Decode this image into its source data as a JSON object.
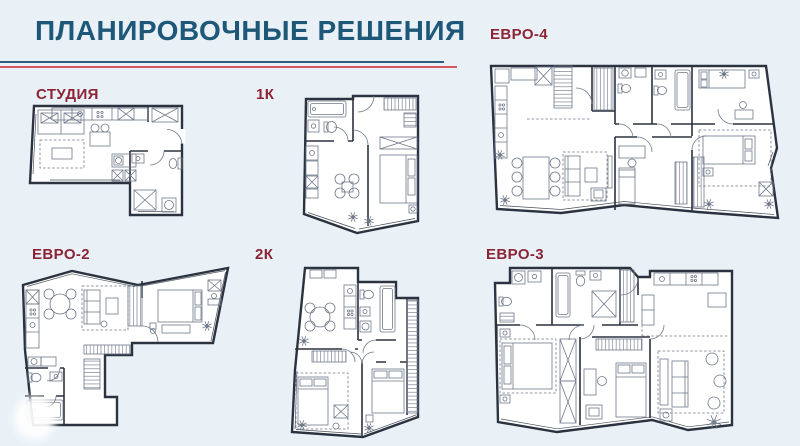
{
  "header": {
    "title": "ПЛАНИРОВОЧНЫЕ РЕШЕНИЯ"
  },
  "plans": [
    {
      "id": "studio",
      "label": "СТУДИЯ"
    },
    {
      "id": "one-room",
      "label": "1К"
    },
    {
      "id": "euro-4",
      "label": "ЕВРО-4"
    },
    {
      "id": "euro-2",
      "label": "ЕВРО-2"
    },
    {
      "id": "two-room",
      "label": "2К"
    },
    {
      "id": "euro-3",
      "label": "ЕВРО-3"
    }
  ],
  "colors": {
    "background": "#e9f1f7",
    "title": "#1e5878",
    "label": "#8c2435",
    "rule_teal": "#2e5d7e",
    "rule_red": "#d15b5f",
    "wall": "#2b3240",
    "furniture": "#6f7889",
    "room_fill": "#ffffff"
  }
}
